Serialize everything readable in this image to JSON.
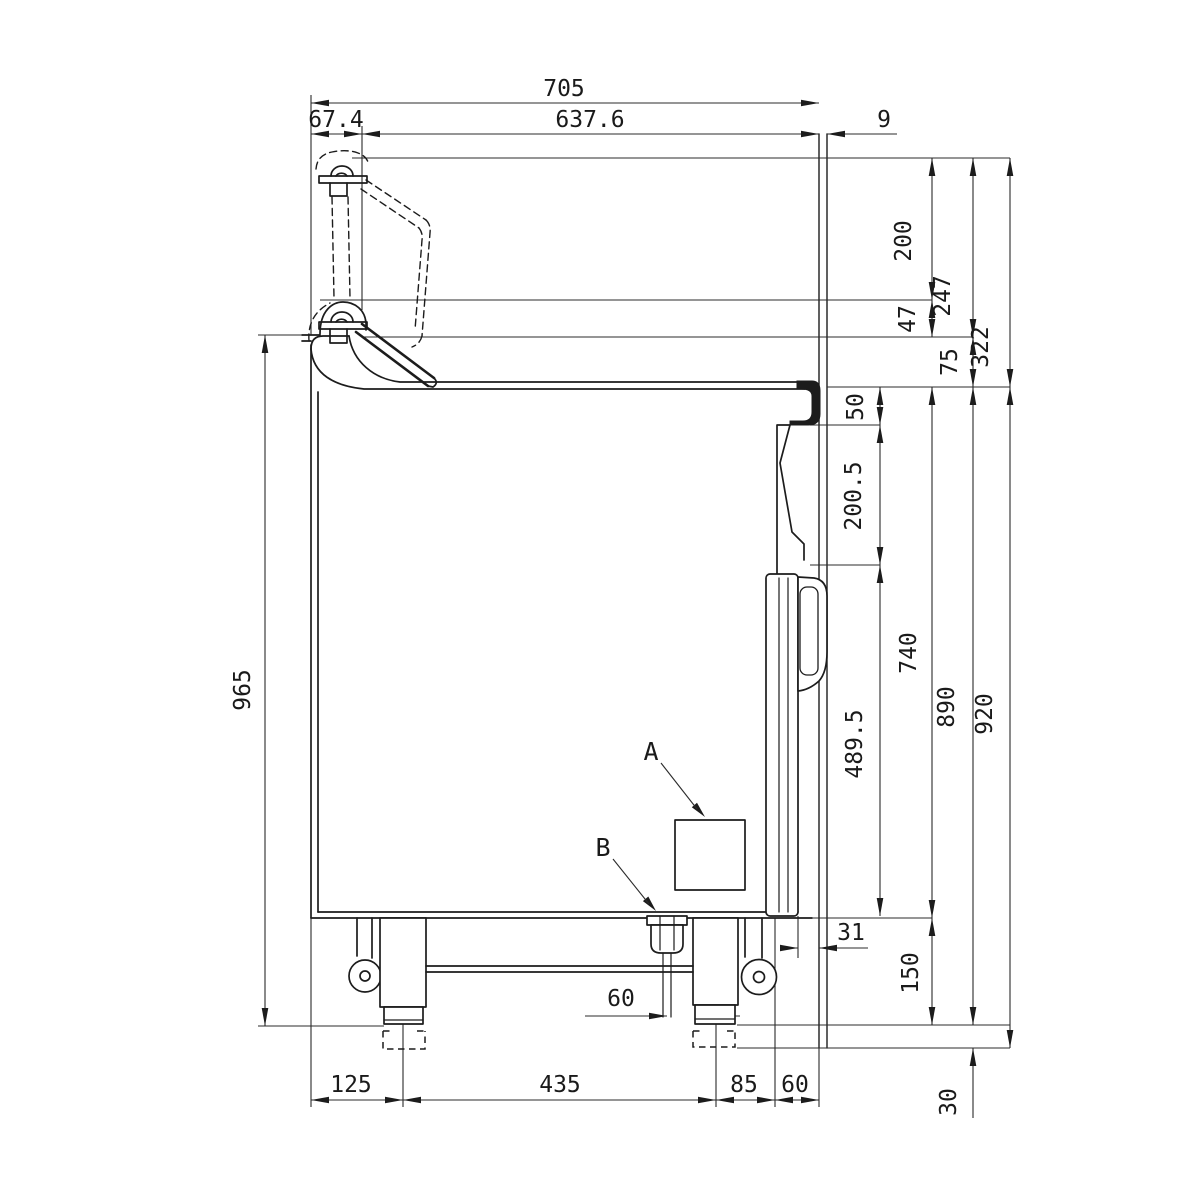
{
  "drawing": {
    "callouts": {
      "a": "A",
      "b": "B"
    },
    "dims_top": {
      "overall": "705",
      "front": "67.4",
      "main": "637.6",
      "rear": "9"
    },
    "dims_right_upper": {
      "d200": "200",
      "d247": "247",
      "d322": "322",
      "d47": "47",
      "d75": "75"
    },
    "dims_right_mid": {
      "d50": "50",
      "d200_5": "200.5",
      "d740": "740",
      "d890": "890",
      "d920": "920",
      "d489_5": "489.5"
    },
    "dims_right_lower": {
      "d150": "150",
      "d31": "31",
      "d30": "30"
    },
    "dims_left": {
      "d965": "965"
    },
    "dims_bottom": {
      "d125": "125",
      "d435": "435",
      "d85": "85",
      "d60": "60",
      "d60_drain": "60"
    }
  }
}
